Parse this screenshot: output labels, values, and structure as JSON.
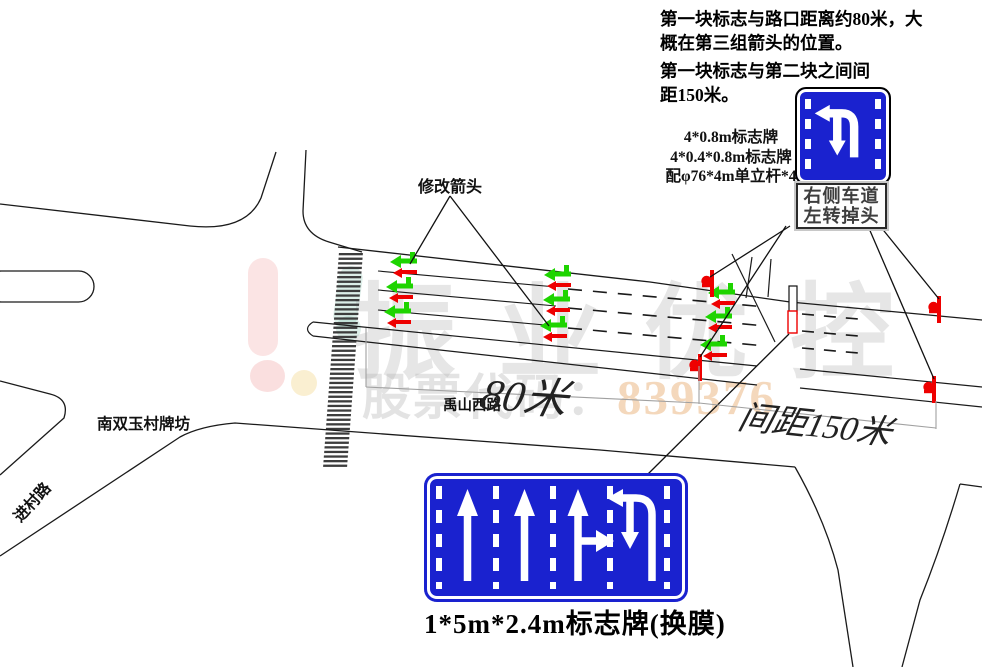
{
  "notes": {
    "line1": "第一块标志与路口距离约80米，大",
    "line2": "概在第三组箭头的位置。",
    "line3": "第一块标志与第二块之间间",
    "line4": "距150米。"
  },
  "spec": {
    "line1": "4*0.8m标志牌",
    "line2": "4*0.4*0.8m标志牌",
    "line3": "配φ76*4m单立杆*4"
  },
  "labels": {
    "modify_arrow": "修改箭头",
    "village_gate": "南双玉村牌坊",
    "village_road": "进村路",
    "road_name": "禹山西路"
  },
  "signs": {
    "small_caption_line1": "右侧车道",
    "small_caption_line2": "左转掉头",
    "large_caption": "1*5m*2.4m标志牌(换膜)"
  },
  "dimensions": {
    "to_junction": "80米",
    "spacing": "间距150米"
  },
  "watermark": {
    "brand": "振业优控",
    "stock_prefix": "股票代码：",
    "stock_code": "839376"
  },
  "colors": {
    "sign_blue": "#1a22cf",
    "mark_red": "#ee0000",
    "mark_green": "#1ed400",
    "line_black": "#1a1a1a",
    "dim_gray": "#a0a0a0"
  }
}
